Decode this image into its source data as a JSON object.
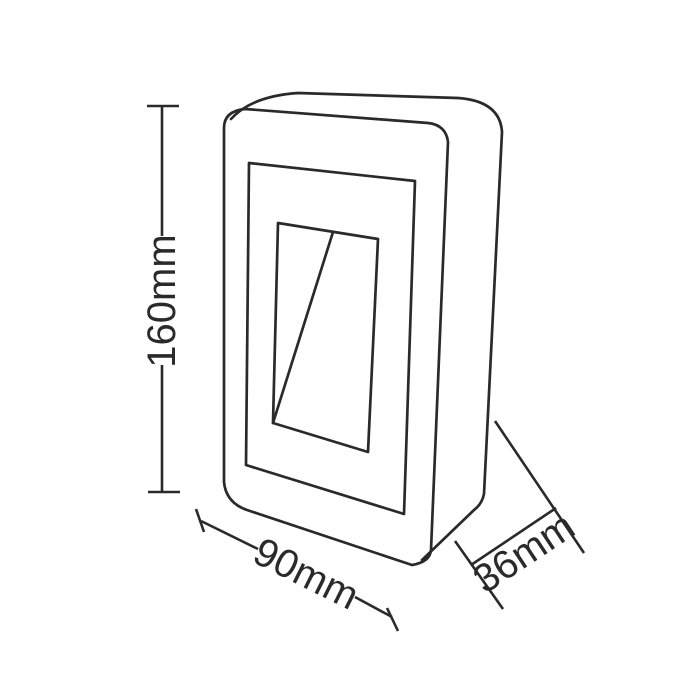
{
  "diagram": {
    "type": "technical-dimension-drawing",
    "dimension_labels": {
      "height": "160mm",
      "width": "90mm",
      "depth": "36mm"
    },
    "colors": {
      "line": "#2a2a2a",
      "background": "#ffffff"
    }
  }
}
